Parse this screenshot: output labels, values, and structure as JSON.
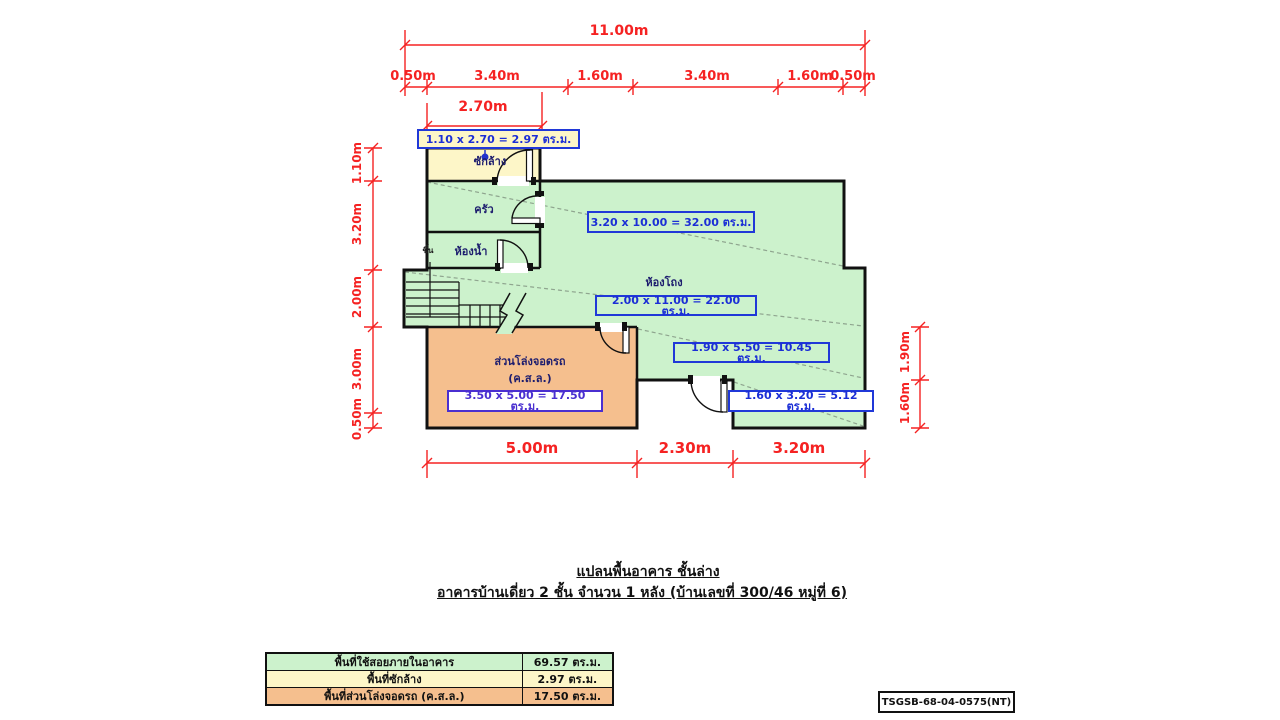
{
  "doc": {
    "title_line1": "แปลนพื้นอาคาร ชั้นล่าง",
    "title_line2": "อาคารบ้านเดี่ยว 2 ชั้น จำนวน 1 หลัง (บ้านเลขที่ 300/46 หมู่ที่ 6)",
    "code": "TSGSB-68-04-0575(NT)"
  },
  "plan": {
    "room_labels": {
      "laundry": "ซักล้าง",
      "kitchen": "ครัว",
      "bathroom": "ห้องน้ำ",
      "hall": "ห้องโถง",
      "parking": "ส่วนโล่งจอดรถ",
      "parking_sub": "(ค.ส.ล.)",
      "stairs_up": "ขึ้น"
    },
    "area_labels": {
      "laundry": "1.10 x 2.70 = 2.97 ตร.ม.",
      "upper_zone": "3.20 x 10.00 = 32.00 ตร.ม.",
      "hall_zone": "2.00 x 11.00 = 22.00 ตร.ม.",
      "right_zone": "1.90 x 5.50 = 10.45 ตร.ม.",
      "lower_right_zone": "1.60 x 3.20 = 5.12 ตร.ม.",
      "parking_zone": "3.50 x 5.00 = 17.50 ตร.ม."
    },
    "dims": {
      "top_total": "11.00m",
      "top_segments": [
        "0.50m",
        "3.40m",
        "1.60m",
        "3.40m",
        "1.60m",
        "0.50m"
      ],
      "top_sub": "2.70m",
      "left": [
        "1.10m",
        "3.20m",
        "2.00m",
        "3.00m",
        "0.50m"
      ],
      "right": [
        "1.90m",
        "1.60m"
      ],
      "bottom": [
        "5.00m",
        "2.30m",
        "3.20m"
      ]
    },
    "colors": {
      "room_green": "#ccf2cc",
      "laundry_yellow": "#fdf6c8",
      "parking_orange": "#f5bf8e",
      "dimension_red": "#f52222",
      "annotation_blue": "#2038d8",
      "wall_black": "#111111"
    }
  },
  "summary_table": {
    "rows": [
      {
        "label": "พื้นที่ใช้สอยภายในอาคาร",
        "value": "69.57 ตร.ม."
      },
      {
        "label": "พื้นที่ซักล้าง",
        "value": "2.97 ตร.ม."
      },
      {
        "label": "พื้นที่ส่วนโล่งจอดรถ (ค.ส.ล.)",
        "value": "17.50 ตร.ม."
      }
    ]
  }
}
